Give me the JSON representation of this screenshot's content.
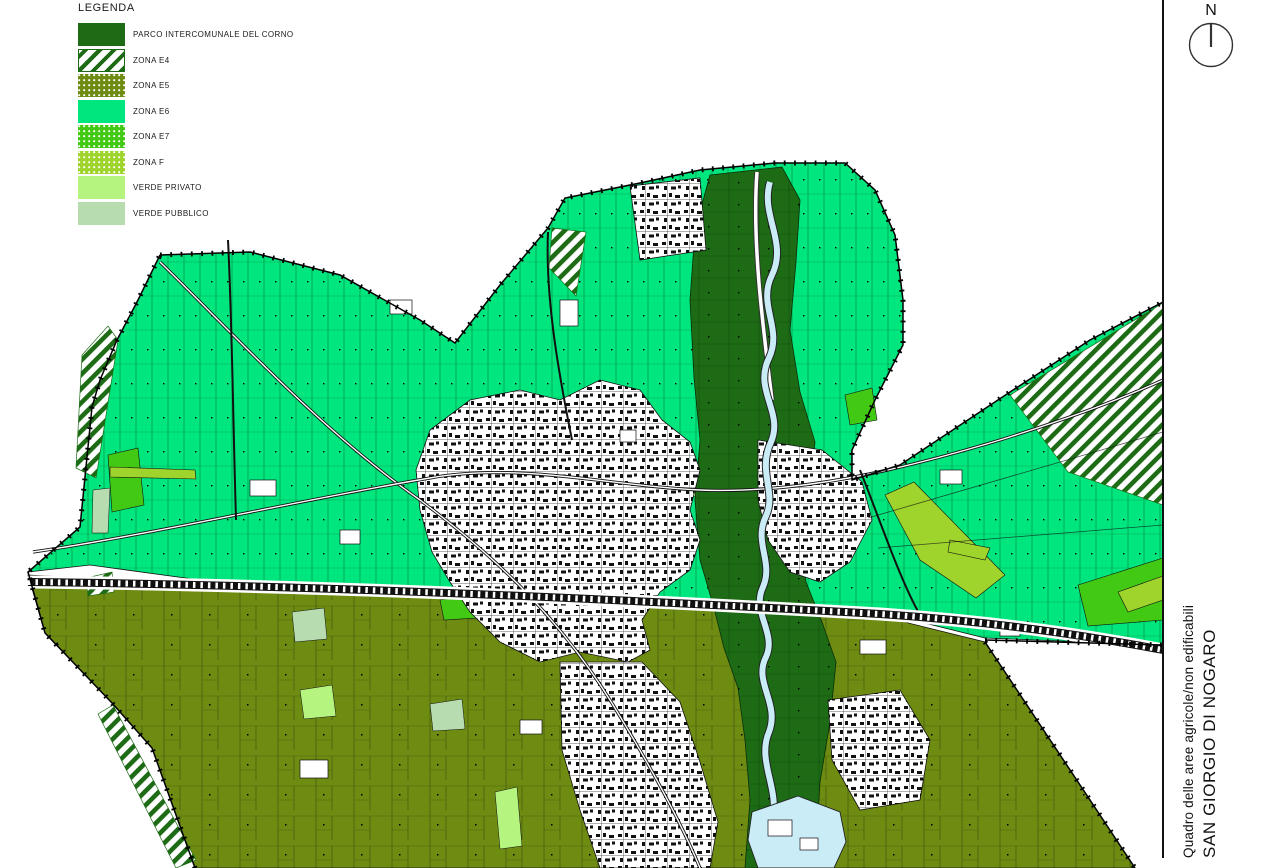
{
  "legend": {
    "title": "LEGENDA",
    "items": [
      {
        "label": "PARCO INTERCOMUNALE DEL CORNO",
        "swatch": "parco"
      },
      {
        "label": "ZONA E4",
        "swatch": "e4"
      },
      {
        "label": "ZONA E5",
        "swatch": "e5"
      },
      {
        "label": "ZONA E6",
        "swatch": "e6"
      },
      {
        "label": "ZONA E7",
        "swatch": "e7"
      },
      {
        "label": "ZONA F",
        "swatch": "f"
      },
      {
        "label": "VERDE PRIVATO",
        "swatch": "verde-privato"
      },
      {
        "label": "VERDE PUBBLICO",
        "swatch": "verde-pubblico"
      }
    ]
  },
  "compass": {
    "label": "N"
  },
  "title_block": {
    "line1": "Quadro delle aree agricole/non edificabili",
    "line2": "SAN GIORGIO DI NOGARO"
  },
  "colors": {
    "parco": "#1d6c15",
    "zona_e4_stripe": "#1d6c15",
    "zona_e5": "#6f8c12",
    "zona_e6": "#00e67e",
    "zona_e7": "#41c913",
    "zona_f": "#9fd42c",
    "verde_privato": "#b5f47e",
    "verde_pubblico": "#b7dcb0",
    "water": "#c9ecf7",
    "line": "#111111"
  }
}
